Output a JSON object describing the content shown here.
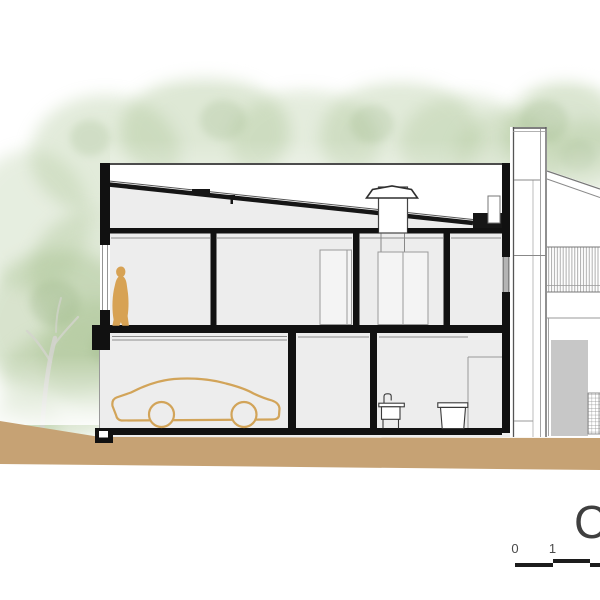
{
  "drawing_title": {
    "section_letter": "C"
  },
  "scale_bar": {
    "tick_labels": [
      "0",
      "1"
    ]
  },
  "palette": {
    "cut_wall": "#161616",
    "interior_fill": "#ededed",
    "ground": "#c6a274",
    "person": "#d7a254",
    "car_outline": "#d2a459",
    "foliage": "#a9c392",
    "thin_line": "#8d8d8d",
    "glass": "#b4b4b4",
    "elevation_door": "#c7c7c7"
  },
  "figures": {
    "person": "person-silhouette",
    "car": "car-outline",
    "sink": "laundry-sink",
    "tank": "laundry-tank",
    "chimney": "chimney",
    "trees": "tree-foliage"
  }
}
